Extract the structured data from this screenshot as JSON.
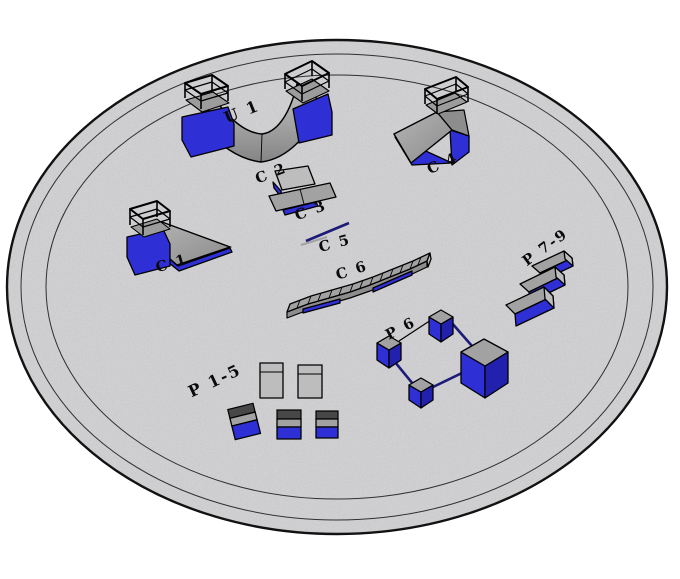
{
  "labels": {
    "u1": "U 1",
    "c1": "C 1",
    "c2": "C 2",
    "c3": "C 3",
    "c4": "C 4",
    "c5": "C 5",
    "c6": "C 6",
    "p1_5": "P 1-5",
    "p6": "P 6",
    "p7_9": "P 7-9"
  },
  "colors": {
    "floor": "#d4d4d6",
    "surface": "#a2a2a2",
    "surface_light": "#bdbdbd",
    "surface_dark": "#8d8d8d",
    "deck": "#9c9c9c",
    "blue": "#2f2fd6",
    "blue_dark": "#2121ad",
    "navy": "#1c1c78",
    "block_top": "#474747",
    "outline": "#000000"
  }
}
